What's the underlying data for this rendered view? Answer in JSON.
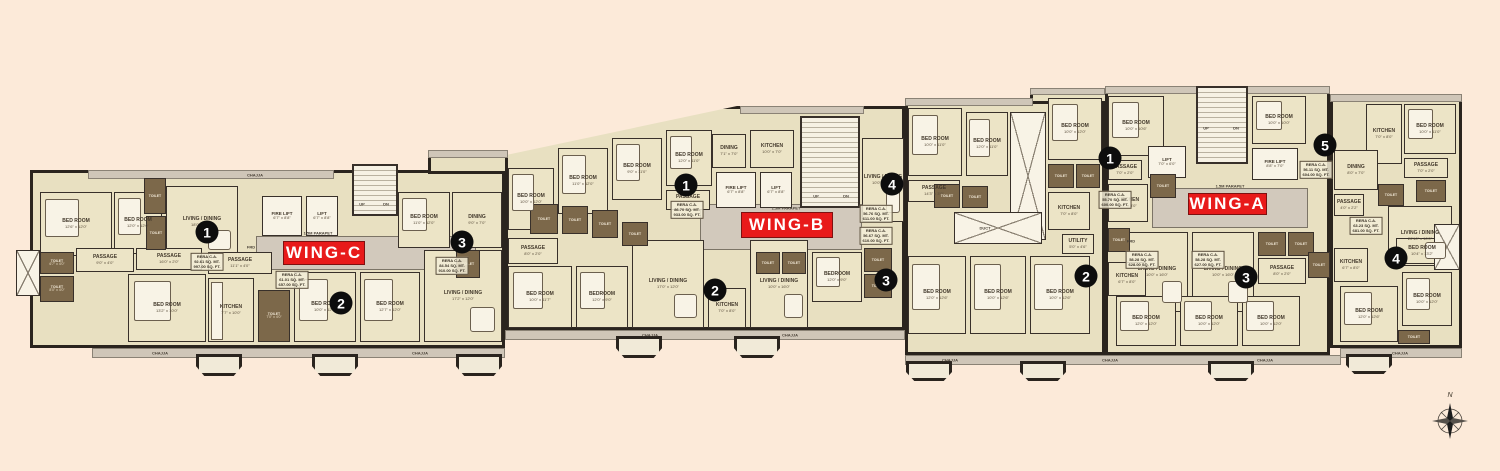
{
  "title": "Typical floor plan with WING-A, WING-B, WING-C",
  "colors": {
    "background": "#fcead9",
    "building_fill": "#e8e0c1",
    "room_fill": "#ece4c6",
    "toilet_fill": "#7c684a",
    "white_fill": "#f8f3e6",
    "chajja_gray": "#cfc6b8",
    "wall": "#2a241e",
    "wing_red": "#e81a1a",
    "unit_circle": "#0d0d0d"
  },
  "strings": {
    "rera_title": "RERA C.A.",
    "sqmt_suffix": "SQ. MT.",
    "sqft_suffix": "SQ. FT."
  },
  "compass": {
    "n": "N",
    "x": 1428,
    "y": 392
  },
  "wings": [
    {
      "label": "WING-C",
      "x": 283,
      "y": 241,
      "w": 82,
      "h": 24
    },
    {
      "label": "WING-B",
      "x": 741,
      "y": 212,
      "w": 92,
      "h": 26
    },
    {
      "label": "WING-A",
      "x": 1188,
      "y": 193,
      "w": 79,
      "h": 22
    }
  ],
  "units": [
    {
      "n": "1",
      "x": 207,
      "y": 232
    },
    {
      "n": "2",
      "x": 341,
      "y": 303
    },
    {
      "n": "3",
      "x": 462,
      "y": 242
    },
    {
      "n": "1",
      "x": 686,
      "y": 185
    },
    {
      "n": "2",
      "x": 715,
      "y": 290
    },
    {
      "n": "4",
      "x": 892,
      "y": 184
    },
    {
      "n": "3",
      "x": 886,
      "y": 280
    },
    {
      "n": "1",
      "x": 1110,
      "y": 158
    },
    {
      "n": "2",
      "x": 1086,
      "y": 276
    },
    {
      "n": "3",
      "x": 1246,
      "y": 277
    },
    {
      "n": "5",
      "x": 1325,
      "y": 145
    },
    {
      "n": "4",
      "x": 1396,
      "y": 258
    }
  ],
  "blocks": [
    {
      "x": 30,
      "y": 170,
      "w": 475,
      "h": 178
    },
    {
      "x": 428,
      "y": 150,
      "w": 80,
      "h": 24
    },
    {
      "x": 505,
      "y": 106,
      "w": 400,
      "h": 224,
      "clip": "polygon(0 22%,58% 0,100% 0,100% 100%,0 100%)"
    },
    {
      "x": 905,
      "y": 98,
      "w": 200,
      "h": 257
    },
    {
      "x": 1030,
      "y": 88,
      "w": 78,
      "h": 16
    },
    {
      "x": 1105,
      "y": 86,
      "w": 225,
      "h": 269
    },
    {
      "x": 1330,
      "y": 94,
      "w": 132,
      "h": 254
    }
  ],
  "bands": [
    {
      "x": 88,
      "y": 170,
      "w": 246,
      "h": 9
    },
    {
      "x": 428,
      "y": 150,
      "w": 80,
      "h": 8
    },
    {
      "x": 740,
      "y": 106,
      "w": 124,
      "h": 8
    },
    {
      "x": 905,
      "y": 98,
      "w": 128,
      "h": 8
    },
    {
      "x": 1030,
      "y": 88,
      "w": 75,
      "h": 7
    },
    {
      "x": 1105,
      "y": 86,
      "w": 225,
      "h": 8
    },
    {
      "x": 1330,
      "y": 94,
      "w": 132,
      "h": 8
    },
    {
      "x": 92,
      "y": 348,
      "w": 413,
      "h": 10
    },
    {
      "x": 505,
      "y": 330,
      "w": 400,
      "h": 10
    },
    {
      "x": 905,
      "y": 355,
      "w": 436,
      "h": 10
    },
    {
      "x": 1340,
      "y": 348,
      "w": 122,
      "h": 10
    }
  ],
  "corridors": [
    {
      "x": 256,
      "y": 236,
      "w": 220,
      "h": 34
    },
    {
      "x": 700,
      "y": 204,
      "w": 162,
      "h": 46
    },
    {
      "x": 1152,
      "y": 188,
      "w": 156,
      "h": 40
    }
  ],
  "rooms": [
    {
      "x": 40,
      "y": 192,
      "w": 72,
      "h": 64,
      "f": "c",
      "n": "BED ROOM",
      "d": "12'6\" x 12'0\""
    },
    {
      "x": 114,
      "y": 192,
      "w": 48,
      "h": 62,
      "f": "c",
      "n": "BED ROOM",
      "d": "12'0\" x 12'0\""
    },
    {
      "x": 166,
      "y": 186,
      "w": 72,
      "h": 72,
      "f": "c",
      "n": "LIVING / DINING",
      "d": "18'0\" x 13'4\""
    },
    {
      "x": 76,
      "y": 248,
      "w": 58,
      "h": 24,
      "f": "c",
      "n": "PASSAGE",
      "d": "9'0\" x 4'0\""
    },
    {
      "x": 136,
      "y": 248,
      "w": 66,
      "h": 22,
      "f": "c",
      "n": "PASSAGE",
      "d": "16'0\" x 2'0\""
    },
    {
      "x": 128,
      "y": 274,
      "w": 78,
      "h": 68,
      "f": "c",
      "n": "BED ROOM",
      "d": "13'2\" x 10'0\""
    },
    {
      "x": 208,
      "y": 252,
      "w": 64,
      "h": 22,
      "f": "c",
      "n": "PASSAGE",
      "d": "11'1\" x 4'0\""
    },
    {
      "x": 208,
      "y": 278,
      "w": 46,
      "h": 64,
      "f": "c",
      "n": "KITCHEN",
      "d": "7'7\" x 10'0\""
    },
    {
      "x": 294,
      "y": 272,
      "w": 62,
      "h": 70,
      "f": "c",
      "n": "BED ROOM",
      "d": "10'0\" x 12'0\""
    },
    {
      "x": 360,
      "y": 272,
      "w": 60,
      "h": 70,
      "f": "c",
      "n": "BED ROOM",
      "d": "12'7\" x 12'0\""
    },
    {
      "x": 424,
      "y": 250,
      "w": 78,
      "h": 92,
      "f": "c",
      "n": "LIVING / DINING",
      "d": "17'2\" x 12'0\""
    },
    {
      "x": 398,
      "y": 192,
      "w": 52,
      "h": 56,
      "f": "c",
      "n": "BED ROOM",
      "d": "11'0\" x 12'0\""
    },
    {
      "x": 452,
      "y": 192,
      "w": 50,
      "h": 56,
      "f": "c",
      "n": "DINING",
      "d": "9'0\" x 7'0\""
    },
    {
      "x": 262,
      "y": 196,
      "w": 40,
      "h": 40,
      "f": "w",
      "n": "FIRE LIFT",
      "d": "6'7\" x 8'8\""
    },
    {
      "x": 306,
      "y": 196,
      "w": 32,
      "h": 40,
      "f": "w",
      "n": "LIFT",
      "d": "6'7\" x 8'8\""
    },
    {
      "x": 352,
      "y": 164,
      "w": 46,
      "h": 52,
      "f": "s",
      "n": "",
      "d": ""
    },
    {
      "x": 16,
      "y": 250,
      "w": 24,
      "h": 46,
      "f": "x",
      "n": "",
      "d": ""
    },
    {
      "x": 144,
      "y": 178,
      "w": 22,
      "h": 36,
      "f": "b",
      "n": "TOILET",
      "d": ""
    },
    {
      "x": 146,
      "y": 216,
      "w": 20,
      "h": 34,
      "f": "b",
      "n": "TOILET",
      "d": ""
    },
    {
      "x": 40,
      "y": 252,
      "w": 34,
      "h": 22,
      "f": "b",
      "n": "TOILET",
      "d": "6'7\" x 4'0\""
    },
    {
      "x": 40,
      "y": 276,
      "w": 34,
      "h": 26,
      "f": "b",
      "n": "TOILET",
      "d": "8'0\" x 4'0\""
    },
    {
      "x": 258,
      "y": 290,
      "w": 32,
      "h": 52,
      "f": "b",
      "n": "TOILET",
      "d": "7'0\" x 4'0\""
    },
    {
      "x": 456,
      "y": 250,
      "w": 24,
      "h": 28,
      "f": "b",
      "n": "TOILET",
      "d": ""
    },
    {
      "x": 508,
      "y": 168,
      "w": 46,
      "h": 62,
      "f": "c",
      "n": "BED ROOM",
      "d": "10'0\" x 12'0\""
    },
    {
      "x": 558,
      "y": 148,
      "w": 50,
      "h": 66,
      "f": "c",
      "n": "BED ROOM",
      "d": "11'0\" x 12'0\""
    },
    {
      "x": 612,
      "y": 138,
      "w": 50,
      "h": 62,
      "f": "c",
      "n": "BED ROOM",
      "d": "9'0\" x 11'0\""
    },
    {
      "x": 666,
      "y": 130,
      "w": 46,
      "h": 56,
      "f": "c",
      "n": "BED ROOM",
      "d": "12'0\" x 11'0\""
    },
    {
      "x": 666,
      "y": 190,
      "w": 44,
      "h": 20,
      "f": "c",
      "n": "PASSAGE",
      "d": "7'1\" x 4'6\""
    },
    {
      "x": 712,
      "y": 134,
      "w": 34,
      "h": 34,
      "f": "c",
      "n": "DINING",
      "d": "7'1\" x 7'0\""
    },
    {
      "x": 750,
      "y": 130,
      "w": 44,
      "h": 38,
      "f": "c",
      "n": "KITCHEN",
      "d": "10'0\" x 7'0\""
    },
    {
      "x": 862,
      "y": 138,
      "w": 42,
      "h": 84,
      "f": "c",
      "n": "LIVING / DINING",
      "d": "10'0\" x 16'0\""
    },
    {
      "x": 508,
      "y": 238,
      "w": 50,
      "h": 26,
      "f": "c",
      "n": "PASSAGE",
      "d": "8'0\" x 2'0\""
    },
    {
      "x": 508,
      "y": 266,
      "w": 64,
      "h": 62,
      "f": "c",
      "n": "BED ROOM",
      "d": "10'0\" x 11'7\""
    },
    {
      "x": 576,
      "y": 266,
      "w": 52,
      "h": 62,
      "f": "c",
      "n": "BEDROOM",
      "d": "12'0\" x 9'0\""
    },
    {
      "x": 632,
      "y": 240,
      "w": 72,
      "h": 88,
      "f": "c",
      "n": "LIVING / DINING",
      "d": "17'0\" x 12'0\""
    },
    {
      "x": 708,
      "y": 288,
      "w": 38,
      "h": 40,
      "f": "c",
      "n": "KITCHEN",
      "d": "7'0\" x 8'0\""
    },
    {
      "x": 750,
      "y": 240,
      "w": 58,
      "h": 88,
      "f": "c",
      "n": "LIVING / DINING",
      "d": "10'0\" x 16'0\""
    },
    {
      "x": 812,
      "y": 252,
      "w": 50,
      "h": 50,
      "f": "c",
      "n": "BEDROOM",
      "d": "12'0\" x 9'0\""
    },
    {
      "x": 716,
      "y": 172,
      "w": 40,
      "h": 36,
      "f": "w",
      "n": "FIRE LIFT",
      "d": "6'7\" x 8'8\""
    },
    {
      "x": 760,
      "y": 172,
      "w": 32,
      "h": 36,
      "f": "w",
      "n": "LIFT",
      "d": "6'7\" x 8'8\""
    },
    {
      "x": 800,
      "y": 116,
      "w": 60,
      "h": 92,
      "f": "s",
      "n": "",
      "d": ""
    },
    {
      "x": 530,
      "y": 204,
      "w": 28,
      "h": 30,
      "f": "b",
      "n": "TOILET",
      "d": ""
    },
    {
      "x": 562,
      "y": 206,
      "w": 26,
      "h": 28,
      "f": "b",
      "n": "TOILET",
      "d": ""
    },
    {
      "x": 592,
      "y": 210,
      "w": 26,
      "h": 28,
      "f": "b",
      "n": "TOILET",
      "d": ""
    },
    {
      "x": 622,
      "y": 222,
      "w": 26,
      "h": 24,
      "f": "b",
      "n": "TOILET",
      "d": ""
    },
    {
      "x": 756,
      "y": 252,
      "w": 24,
      "h": 22,
      "f": "b",
      "n": "TOILET",
      "d": ""
    },
    {
      "x": 782,
      "y": 252,
      "w": 24,
      "h": 22,
      "f": "b",
      "n": "TOILET",
      "d": ""
    },
    {
      "x": 864,
      "y": 248,
      "w": 28,
      "h": 24,
      "f": "b",
      "n": "TOILET",
      "d": ""
    },
    {
      "x": 864,
      "y": 274,
      "w": 28,
      "h": 24,
      "f": "b",
      "n": "TOILET",
      "d": ""
    },
    {
      "x": 908,
      "y": 108,
      "w": 54,
      "h": 68,
      "f": "c",
      "n": "BED ROOM",
      "d": "10'0\" x 11'0\""
    },
    {
      "x": 966,
      "y": 112,
      "w": 42,
      "h": 64,
      "f": "c",
      "n": "BED ROOM",
      "d": "12'0\" x 11'0\""
    },
    {
      "x": 1048,
      "y": 98,
      "w": 54,
      "h": 62,
      "f": "c",
      "n": "BED ROOM",
      "d": "10'0\" x 12'0\""
    },
    {
      "x": 908,
      "y": 180,
      "w": 52,
      "h": 22,
      "f": "c",
      "n": "PASSAGE",
      "d": "14'3\" x 3'0\""
    },
    {
      "x": 1048,
      "y": 192,
      "w": 42,
      "h": 38,
      "f": "c",
      "n": "KITCHEN",
      "d": "7'0\" x 8'0\""
    },
    {
      "x": 1062,
      "y": 234,
      "w": 32,
      "h": 20,
      "f": "c",
      "n": "UTILITY",
      "d": "5'0\" x 4'6\""
    },
    {
      "x": 908,
      "y": 256,
      "w": 58,
      "h": 78,
      "f": "c",
      "n": "BED ROOM",
      "d": "12'0\" x 12'6\""
    },
    {
      "x": 970,
      "y": 256,
      "w": 56,
      "h": 78,
      "f": "c",
      "n": "BED ROOM",
      "d": "10'0\" x 12'6\""
    },
    {
      "x": 1030,
      "y": 256,
      "w": 60,
      "h": 78,
      "f": "c",
      "n": "BED ROOM",
      "d": "10'0\" x 12'6\""
    },
    {
      "x": 1010,
      "y": 112,
      "w": 36,
      "h": 128,
      "f": "x",
      "n": "",
      "d": ""
    },
    {
      "x": 954,
      "y": 212,
      "w": 88,
      "h": 32,
      "f": "x",
      "n": "",
      "d": ""
    },
    {
      "x": 934,
      "y": 184,
      "w": 26,
      "h": 24,
      "f": "b",
      "n": "TOILET",
      "d": ""
    },
    {
      "x": 962,
      "y": 186,
      "w": 26,
      "h": 22,
      "f": "b",
      "n": "TOILET",
      "d": ""
    },
    {
      "x": 1048,
      "y": 164,
      "w": 26,
      "h": 24,
      "f": "b",
      "n": "TOILET",
      "d": ""
    },
    {
      "x": 1076,
      "y": 164,
      "w": 24,
      "h": 24,
      "f": "b",
      "n": "TOILET",
      "d": ""
    },
    {
      "x": 1108,
      "y": 96,
      "w": 56,
      "h": 60,
      "f": "c",
      "n": "BED ROOM",
      "d": "10'0\" x 10'6\""
    },
    {
      "x": 1108,
      "y": 160,
      "w": 34,
      "h": 20,
      "f": "c",
      "n": "PASSAGE",
      "d": "7'0\" x 2'0\""
    },
    {
      "x": 1108,
      "y": 184,
      "w": 40,
      "h": 38,
      "f": "c",
      "n": "KITCHEN",
      "d": "7'0\" x 8'0\""
    },
    {
      "x": 1252,
      "y": 96,
      "w": 54,
      "h": 48,
      "f": "c",
      "n": "BED ROOM",
      "d": "10'0\" x 10'0\""
    },
    {
      "x": 1126,
      "y": 232,
      "w": 62,
      "h": 80,
      "f": "c",
      "n": "LIVING / DINING",
      "d": "10'0\" x 16'0\""
    },
    {
      "x": 1192,
      "y": 232,
      "w": 62,
      "h": 80,
      "f": "c",
      "n": "LIVING / DINING",
      "d": "10'0\" x 16'0\""
    },
    {
      "x": 1108,
      "y": 262,
      "w": 38,
      "h": 34,
      "f": "c",
      "n": "KITCHEN",
      "d": "6'7\" x 8'0\""
    },
    {
      "x": 1116,
      "y": 296,
      "w": 60,
      "h": 50,
      "f": "c",
      "n": "BED ROOM",
      "d": "12'0\" x 12'0\""
    },
    {
      "x": 1180,
      "y": 296,
      "w": 58,
      "h": 50,
      "f": "c",
      "n": "BED ROOM",
      "d": "10'0\" x 12'0\""
    },
    {
      "x": 1242,
      "y": 296,
      "w": 58,
      "h": 50,
      "f": "c",
      "n": "BED ROOM",
      "d": "10'0\" x 12'0\""
    },
    {
      "x": 1258,
      "y": 258,
      "w": 48,
      "h": 26,
      "f": "c",
      "n": "PASSAGE",
      "d": "8'0\" x 2'0\""
    },
    {
      "x": 1148,
      "y": 146,
      "w": 38,
      "h": 32,
      "f": "w",
      "n": "LIFT",
      "d": "7'0\" x 6'0\""
    },
    {
      "x": 1196,
      "y": 86,
      "w": 52,
      "h": 78,
      "f": "s",
      "n": "",
      "d": ""
    },
    {
      "x": 1252,
      "y": 148,
      "w": 46,
      "h": 32,
      "f": "w",
      "n": "FIRE LIFT",
      "d": "8'8\" x 7'0\""
    },
    {
      "x": 1150,
      "y": 174,
      "w": 26,
      "h": 24,
      "f": "b",
      "n": "TOILET",
      "d": ""
    },
    {
      "x": 1258,
      "y": 232,
      "w": 28,
      "h": 24,
      "f": "b",
      "n": "TOILET",
      "d": ""
    },
    {
      "x": 1288,
      "y": 232,
      "w": 26,
      "h": 24,
      "f": "b",
      "n": "TOILET",
      "d": ""
    },
    {
      "x": 1308,
      "y": 252,
      "w": 22,
      "h": 26,
      "f": "b",
      "n": "TOILET",
      "d": ""
    },
    {
      "x": 1108,
      "y": 228,
      "w": 22,
      "h": 24,
      "f": "b",
      "n": "TOILET",
      "d": ""
    },
    {
      "x": 1366,
      "y": 104,
      "w": 36,
      "h": 60,
      "f": "c",
      "n": "KITCHEN",
      "d": "7'0\" x 8'0\""
    },
    {
      "x": 1404,
      "y": 104,
      "w": 52,
      "h": 50,
      "f": "c",
      "n": "BED ROOM",
      "d": "10'0\" x 11'0\""
    },
    {
      "x": 1334,
      "y": 150,
      "w": 44,
      "h": 40,
      "f": "c",
      "n": "DINING",
      "d": "8'0\" x 7'0\""
    },
    {
      "x": 1404,
      "y": 158,
      "w": 44,
      "h": 20,
      "f": "c",
      "n": "PASSAGE",
      "d": "7'0\" x 2'0\""
    },
    {
      "x": 1388,
      "y": 206,
      "w": 64,
      "h": 60,
      "f": "c",
      "n": "LIVING / DINING",
      "d": "20'10\" x 10'0\""
    },
    {
      "x": 1334,
      "y": 194,
      "w": 30,
      "h": 22,
      "f": "c",
      "n": "PASSAGE",
      "d": "4'0\" x 2'2\""
    },
    {
      "x": 1334,
      "y": 248,
      "w": 34,
      "h": 34,
      "f": "c",
      "n": "KITCHEN",
      "d": "6'7\" x 8'0\""
    },
    {
      "x": 1396,
      "y": 238,
      "w": 52,
      "h": 26,
      "f": "c",
      "n": "BED ROOM",
      "d": "10'4\" x 13'2\""
    },
    {
      "x": 1340,
      "y": 286,
      "w": 58,
      "h": 56,
      "f": "c",
      "n": "BED ROOM",
      "d": "12'0\" x 12'6\""
    },
    {
      "x": 1402,
      "y": 272,
      "w": 50,
      "h": 54,
      "f": "c",
      "n": "BED ROOM",
      "d": "10'0\" x 12'0\""
    },
    {
      "x": 1434,
      "y": 224,
      "w": 26,
      "h": 46,
      "f": "x",
      "n": "",
      "d": ""
    },
    {
      "x": 1416,
      "y": 180,
      "w": 30,
      "h": 22,
      "f": "b",
      "n": "TOILET",
      "d": ""
    },
    {
      "x": 1378,
      "y": 184,
      "w": 26,
      "h": 22,
      "f": "b",
      "n": "TOILET",
      "d": ""
    },
    {
      "x": 1398,
      "y": 330,
      "w": 32,
      "h": 14,
      "f": "b",
      "n": "TOILET",
      "d": ""
    }
  ],
  "bays": [
    {
      "x": 196,
      "y": 354,
      "w": 46,
      "h": 22
    },
    {
      "x": 312,
      "y": 354,
      "w": 46,
      "h": 22
    },
    {
      "x": 456,
      "y": 354,
      "w": 46,
      "h": 22
    },
    {
      "x": 616,
      "y": 336,
      "w": 46,
      "h": 22
    },
    {
      "x": 734,
      "y": 336,
      "w": 46,
      "h": 22
    },
    {
      "x": 906,
      "y": 361,
      "w": 46,
      "h": 20
    },
    {
      "x": 1020,
      "y": 361,
      "w": 46,
      "h": 20
    },
    {
      "x": 1208,
      "y": 361,
      "w": 46,
      "h": 20
    },
    {
      "x": 1346,
      "y": 354,
      "w": 46,
      "h": 20
    }
  ],
  "rera_blocks": [
    {
      "x": 207,
      "y": 262,
      "mt": "92.61",
      "ft": "997.00"
    },
    {
      "x": 292,
      "y": 280,
      "mt": "61.01",
      "ft": "657.00"
    },
    {
      "x": 452,
      "y": 266,
      "mt": "84.54",
      "ft": "910.00"
    },
    {
      "x": 687,
      "y": 210,
      "mt": "86.70",
      "ft": "933.00"
    },
    {
      "x": 876,
      "y": 214,
      "mt": "56.76",
      "ft": "611.00"
    },
    {
      "x": 876,
      "y": 236,
      "mt": "56.67",
      "ft": "610.00"
    },
    {
      "x": 1115,
      "y": 200,
      "mt": "55.70",
      "ft": "600.00"
    },
    {
      "x": 1142,
      "y": 260,
      "mt": "58.28",
      "ft": "628.00"
    },
    {
      "x": 1208,
      "y": 260,
      "mt": "58.28",
      "ft": "627.00"
    },
    {
      "x": 1316,
      "y": 170,
      "mt": "56.11",
      "ft": "604.00"
    },
    {
      "x": 1366,
      "y": 226,
      "mt": "63.23",
      "ft": "681.00"
    }
  ],
  "notes": [
    {
      "x": 160,
      "y": 353,
      "t": "CHAJJA"
    },
    {
      "x": 255,
      "y": 175,
      "t": "CHAJJA"
    },
    {
      "x": 420,
      "y": 353,
      "t": "CHAJJA"
    },
    {
      "x": 650,
      "y": 335,
      "t": "CHAJJA"
    },
    {
      "x": 790,
      "y": 335,
      "t": "CHAJJA"
    },
    {
      "x": 950,
      "y": 360,
      "t": "CHAJJA"
    },
    {
      "x": 1110,
      "y": 360,
      "t": "CHAJJA"
    },
    {
      "x": 1265,
      "y": 360,
      "t": "CHAJJA"
    },
    {
      "x": 1400,
      "y": 353,
      "t": "CHAJJA"
    },
    {
      "x": 318,
      "y": 233,
      "t": "1.5M PARAPET"
    },
    {
      "x": 786,
      "y": 208,
      "t": "1.5M PARAPET"
    },
    {
      "x": 1230,
      "y": 186,
      "t": "1.5M PARAPET"
    },
    {
      "x": 985,
      "y": 228,
      "t": "DUCT"
    },
    {
      "x": 362,
      "y": 204,
      "t": "UP"
    },
    {
      "x": 386,
      "y": 204,
      "t": "DN"
    },
    {
      "x": 816,
      "y": 196,
      "t": "UP"
    },
    {
      "x": 846,
      "y": 196,
      "t": "DN"
    },
    {
      "x": 1206,
      "y": 128,
      "t": "UP"
    },
    {
      "x": 1236,
      "y": 128,
      "t": "DN"
    },
    {
      "x": 251,
      "y": 247,
      "t": "FRD"
    },
    {
      "x": 1131,
      "y": 241,
      "t": "FRD"
    }
  ]
}
